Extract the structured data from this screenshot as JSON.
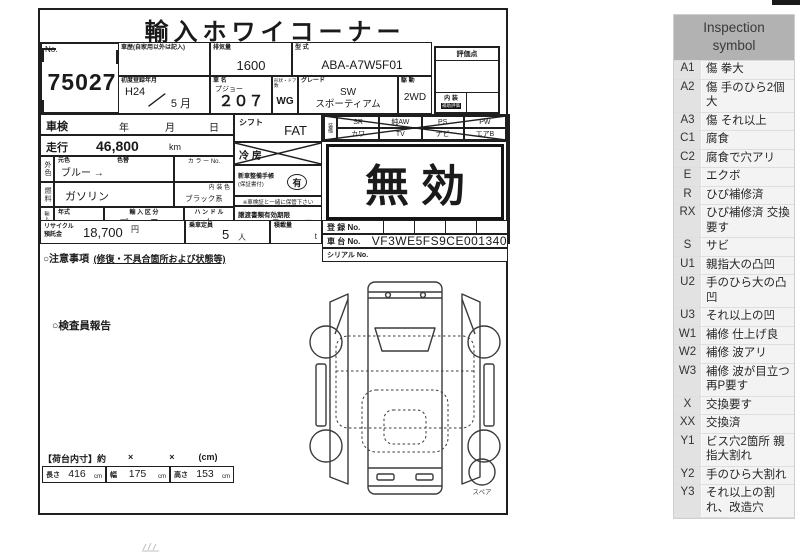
{
  "sheet": {
    "title": "輸入ホワイコーナー",
    "no_label": "No.",
    "auction_no": "75027",
    "header": {
      "history_label": "車歴(自家用以外は記入)",
      "displacement_label": "排気量",
      "displacement": "1600",
      "model_label": "型 式",
      "model": "ABA-A7W5F01",
      "first_reg_label": "初度登録年月",
      "first_reg_year": "H24",
      "first_reg_slash": "／",
      "first_reg_month": "5 月",
      "name_label": "車 名",
      "brand": "プジョー",
      "model_name": "２０７",
      "body_door_label": "形状・ドア数",
      "body_door": "WG",
      "grade_label": "グレード",
      "grade_line1": "SW",
      "grade_line2": "スポーティアム",
      "drive_label": "駆 動",
      "drive": "2WD",
      "score_label": "評価点",
      "interior_label": "内 装",
      "aux_label": "補助評価"
    },
    "fields": {
      "shaken_label": "車検",
      "year_label": "年",
      "month_label": "月",
      "day_label": "日",
      "mileage_label": "走行",
      "mileage": "46,800",
      "mileage_unit": "km",
      "ext_color_label": "外色",
      "orig_color_label": "元色",
      "orig_color": "ブルー →",
      "color_change_label": "色替",
      "color_no_label": "カ ラ ー No.",
      "fuel_label": "燃料",
      "fuel": "ガソリン",
      "interior_color_label": "内 装 色",
      "interior_color": "ブラック系",
      "import_label": "輸入車用",
      "year_model_label": "年式",
      "import_type_label": "輸 入 区 分",
      "import_type": "ディーラー",
      "handle_label": "ハ ン ド ル",
      "handle": "右",
      "shift_label": "シフト",
      "shift": "FAT",
      "ac_label": "冷 房",
      "service_book_label": "新車整備手帳",
      "service_book_sub": "(保証書付)",
      "service_book_value": "有",
      "keep_note": "※車検証と一緒に保管下さい",
      "transfer_label": "譲渡書類有効期限",
      "transfer_month": "月",
      "transfer_day": "日",
      "equipment_label": "装備",
      "invalid_stamp": "無効",
      "recycle_label1": "リサイクル",
      "recycle_label2": "預託金",
      "recycle_fee": "18,700",
      "recycle_unit": "円",
      "capacity_label": "乗車定員",
      "capacity": "5",
      "capacity_unit": "人",
      "load_label": "積載量",
      "load_unit": "t",
      "reg_label": "登 録 No.",
      "chassis_label": "車 台 No.",
      "chassis_no": "VF3WE5FS9CE001340",
      "serial_label": "シリアル No.",
      "notes_label": "○注意事項",
      "notes_sub": "(修復・不具合箇所および状態等)",
      "inspector_label": "○検査員報告"
    },
    "equipment": [
      "SR",
      "純AW",
      "PS",
      "PW",
      "カワ",
      "TV",
      "ナビ",
      "エアB"
    ],
    "dims": {
      "caption": "【荷台内寸】約",
      "times1": "×",
      "times2": "×",
      "unit_caption": "(cm)",
      "length_label": "長さ",
      "length": "416",
      "width_label": "幅",
      "width": "175",
      "height_label": "高さ",
      "height": "153",
      "cm": "cm"
    },
    "spare_label": "スペア"
  },
  "sidebar": {
    "title": "Inspection symbol",
    "rows": [
      {
        "code": "A1",
        "desc": "傷 拳大"
      },
      {
        "code": "A2",
        "desc": "傷 手のひら2個大"
      },
      {
        "code": "A3",
        "desc": "傷 それ以上"
      },
      {
        "code": "C1",
        "desc": "腐食"
      },
      {
        "code": "C2",
        "desc": "腐食で穴アリ"
      },
      {
        "code": "E",
        "desc": "エクボ"
      },
      {
        "code": "R",
        "desc": "ひび補修済"
      },
      {
        "code": "RX",
        "desc": "ひび補修済 交換要す"
      },
      {
        "code": "S",
        "desc": "サビ"
      },
      {
        "code": "U1",
        "desc": "親指大の凸凹"
      },
      {
        "code": "U2",
        "desc": "手のひら大の凸凹"
      },
      {
        "code": "U3",
        "desc": "それ以上の凹"
      },
      {
        "code": "W1",
        "desc": "補修 仕上げ良"
      },
      {
        "code": "W2",
        "desc": "補修 波アリ"
      },
      {
        "code": "W3",
        "desc": "補修 波が目立つ　再P要す"
      },
      {
        "code": "X",
        "desc": "交換要す"
      },
      {
        "code": "XX",
        "desc": "交換済"
      },
      {
        "code": "Y1",
        "desc": "ビス穴2箇所 親指大割れ"
      },
      {
        "code": "Y2",
        "desc": "手のひら大割れ"
      },
      {
        "code": "Y3",
        "desc": "それ以上の割れ、改造穴"
      }
    ]
  }
}
